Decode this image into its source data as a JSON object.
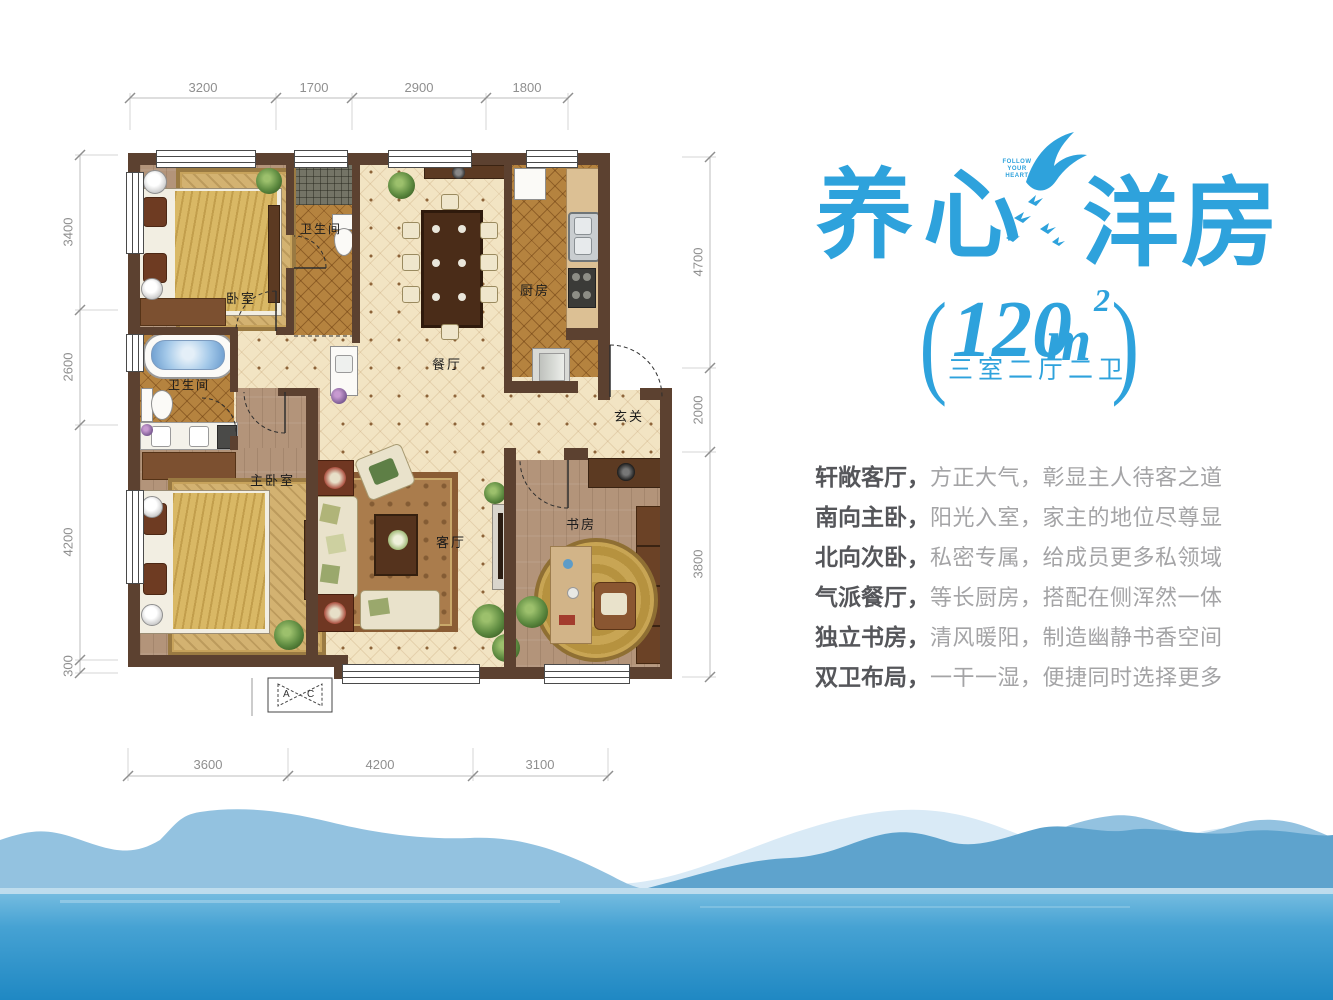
{
  "hero": {
    "title_left": "养心",
    "title_right": "洋房",
    "slogan": [
      "FOLLOW",
      "YOUR",
      "HEART"
    ],
    "paren_l": "(",
    "paren_r": ")",
    "area": "120",
    "area_unit": "m",
    "area_exp": "2",
    "layout": "三室二厅二卫"
  },
  "features": [
    {
      "lead": "轩敞客厅，",
      "body": "方正大气，彰显主人待客之道"
    },
    {
      "lead": "南向主卧，",
      "body": "阳光入室，家主的地位尽尊显"
    },
    {
      "lead": "北向次卧，",
      "body": "私密专属，给成员更多私领域"
    },
    {
      "lead": "气派餐厅，",
      "body": "等长厨房，搭配在侧浑然一体"
    },
    {
      "lead": "独立书房，",
      "body": "清风暖阳，制造幽静书香空间"
    },
    {
      "lead": "双卫布局，",
      "body": "一干一湿，便捷同时选择更多"
    }
  ],
  "plan": {
    "rooms": {
      "bedroom": "卧室",
      "bath_top": "卫生间",
      "dining": "餐厅",
      "kitchen": "厨房",
      "entry": "玄关",
      "bath_left": "卫生间",
      "master": "主卧室",
      "living": "客厅",
      "study": "书房"
    },
    "dims": {
      "top": [
        "3200",
        "1700",
        "2900",
        "1800"
      ],
      "left": [
        "3400",
        "2600",
        "4200",
        "300"
      ],
      "right": [
        "4700",
        "2000",
        "3800"
      ],
      "bottom": [
        "3600",
        "4200",
        "3100"
      ]
    },
    "ac": {
      "a": "A",
      "c": "C"
    }
  },
  "colors": {
    "accent_blue": "#2ea2dc",
    "wall_brown": "#5c4130",
    "tile_cream": "#f2e4c3",
    "tile_amber": "#b5833f",
    "wood": "#b3947a",
    "feature_lead": "#55565a",
    "feature_body": "#a4a4a6",
    "water_top": "#6ab7de",
    "water_bottom": "#1f88c3"
  }
}
